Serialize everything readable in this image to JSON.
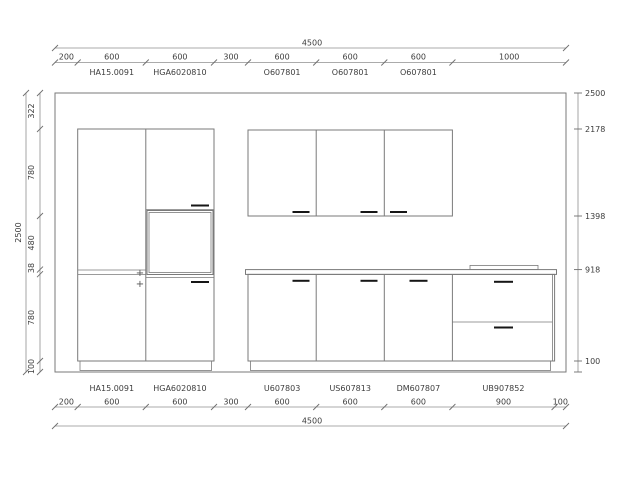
{
  "colors": {
    "background": "#ffffff",
    "cabinet_line": "#7a7a7a",
    "dimension_line": "#8f8f8f",
    "text": "#3d3d3d",
    "handle": "#161616"
  },
  "drawing": {
    "top": {
      "overall": "4500",
      "segments": [
        "200",
        "600",
        "600",
        "300",
        "600",
        "600",
        "600",
        "1000"
      ],
      "codes": [
        "HA15.0091",
        "HGA6020810",
        "O607801",
        "O607801",
        "O607801"
      ]
    },
    "bottom": {
      "overall": "4500",
      "segments": [
        "200",
        "600",
        "600",
        "300",
        "600",
        "600",
        "600",
        "900",
        "100"
      ],
      "codes": [
        "HA15.0091",
        "HGA6020810",
        "U607803",
        "US607813",
        "DM607807",
        "UB907852"
      ]
    },
    "left": {
      "overall": "2500",
      "segments": [
        "322",
        "780",
        "480",
        "38",
        "780",
        "100"
      ]
    },
    "right_levels": [
      "2500",
      "2178",
      "1398",
      "918",
      "100"
    ],
    "plus_marks": [
      "+",
      "+"
    ]
  }
}
